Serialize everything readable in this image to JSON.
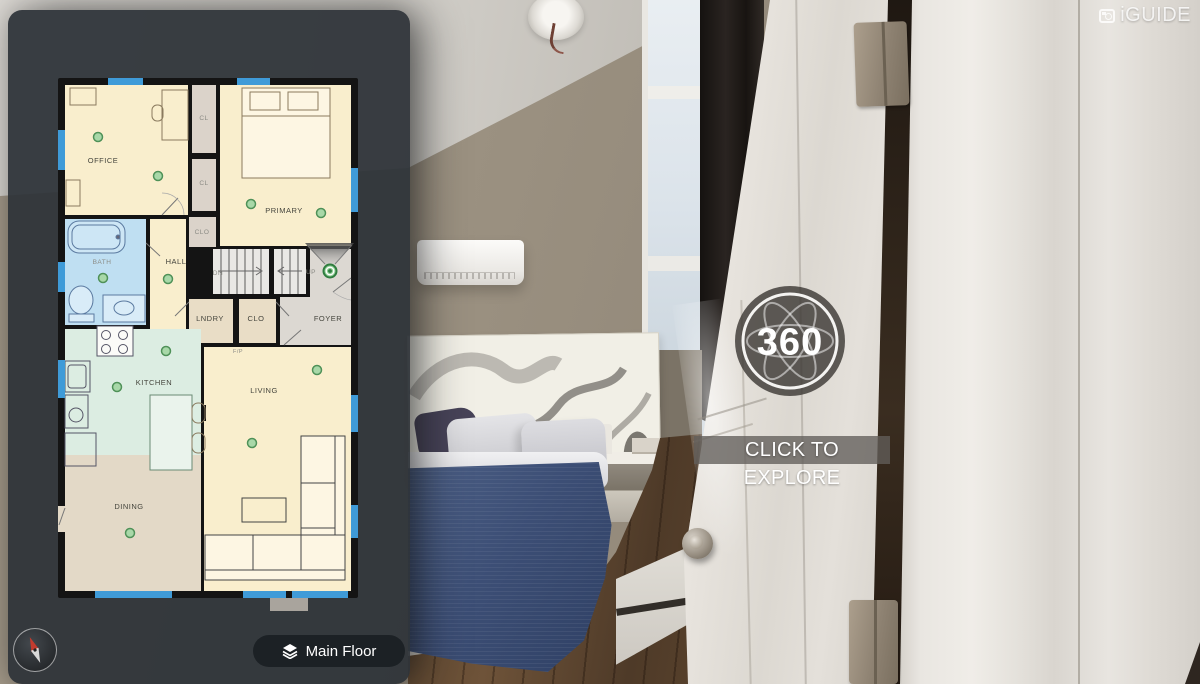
{
  "brand": {
    "logo_text": "iGUIDE"
  },
  "panorama": {
    "badge_label": "360",
    "cta_label": "CLICK TO EXPLORE"
  },
  "floorplan": {
    "floor_selector_label": "Main Floor",
    "rooms": [
      {
        "label": "OFFICE",
        "x": 45,
        "y": 85
      },
      {
        "label": "CL",
        "x": 146,
        "y": 42,
        "small": true
      },
      {
        "label": "CL",
        "x": 146,
        "y": 107,
        "small": true
      },
      {
        "label": "PRIMARY",
        "x": 226,
        "y": 135
      },
      {
        "label": "CLO",
        "x": 144,
        "y": 156,
        "small": true
      },
      {
        "label": "BATH",
        "x": 44,
        "y": 186,
        "small": true
      },
      {
        "label": "HALL",
        "x": 118,
        "y": 186
      },
      {
        "label": "DN",
        "x": 160,
        "y": 197,
        "small": true
      },
      {
        "label": "UP",
        "x": 253,
        "y": 196,
        "small": true
      },
      {
        "label": "LNDRY",
        "x": 152,
        "y": 243
      },
      {
        "label": "CLO",
        "x": 198,
        "y": 243
      },
      {
        "label": "FOYER",
        "x": 270,
        "y": 243
      },
      {
        "label": "KITCHEN",
        "x": 96,
        "y": 307
      },
      {
        "label": "F/P",
        "x": 180,
        "y": 275,
        "tiny": true
      },
      {
        "label": "LIVING",
        "x": 206,
        "y": 315
      },
      {
        "label": "DINING",
        "x": 71,
        "y": 431
      }
    ],
    "markers": [
      {
        "x": 40,
        "y": 59
      },
      {
        "x": 100,
        "y": 98
      },
      {
        "x": 193,
        "y": 126
      },
      {
        "x": 263,
        "y": 135
      },
      {
        "x": 45,
        "y": 200
      },
      {
        "x": 110,
        "y": 201
      },
      {
        "x": 108,
        "y": 273
      },
      {
        "x": 59,
        "y": 309
      },
      {
        "x": 259,
        "y": 292
      },
      {
        "x": 194,
        "y": 365
      },
      {
        "x": 72,
        "y": 455
      }
    ],
    "active_marker": {
      "x": 272,
      "y": 193
    },
    "windows": [
      {
        "x": 50,
        "y": 0,
        "w": 35,
        "h": 7
      },
      {
        "x": 179,
        "y": 0,
        "w": 33,
        "h": 7
      },
      {
        "x": 0,
        "y": 52,
        "w": 7,
        "h": 40
      },
      {
        "x": 0,
        "y": 184,
        "w": 7,
        "h": 30
      },
      {
        "x": 0,
        "y": 282,
        "w": 7,
        "h": 38
      },
      {
        "x": 293,
        "y": 90,
        "w": 7,
        "h": 44
      },
      {
        "x": 293,
        "y": 317,
        "w": 7,
        "h": 37
      },
      {
        "x": 293,
        "y": 427,
        "w": 7,
        "h": 33
      },
      {
        "x": 37,
        "y": 513,
        "w": 77,
        "h": 7
      },
      {
        "x": 185,
        "y": 513,
        "w": 43,
        "h": 7
      },
      {
        "x": 234,
        "y": 513,
        "w": 56,
        "h": 7
      }
    ],
    "colors": {
      "window_blue": "#3f9bd8",
      "marker_green": "#a8d8a8",
      "marker_border": "#4f9158",
      "active_green": "#2f7d3f",
      "room_cream": "#f9eecd",
      "room_gray": "#dbd3ca",
      "room_tan": "#e9ddc6",
      "room_blue": "#bfdff2",
      "room_mint": "#dcede2",
      "room_beige": "#e3d9c7",
      "room_foyer": "#dcd8d2",
      "stairs": "#e9e8e5"
    }
  }
}
